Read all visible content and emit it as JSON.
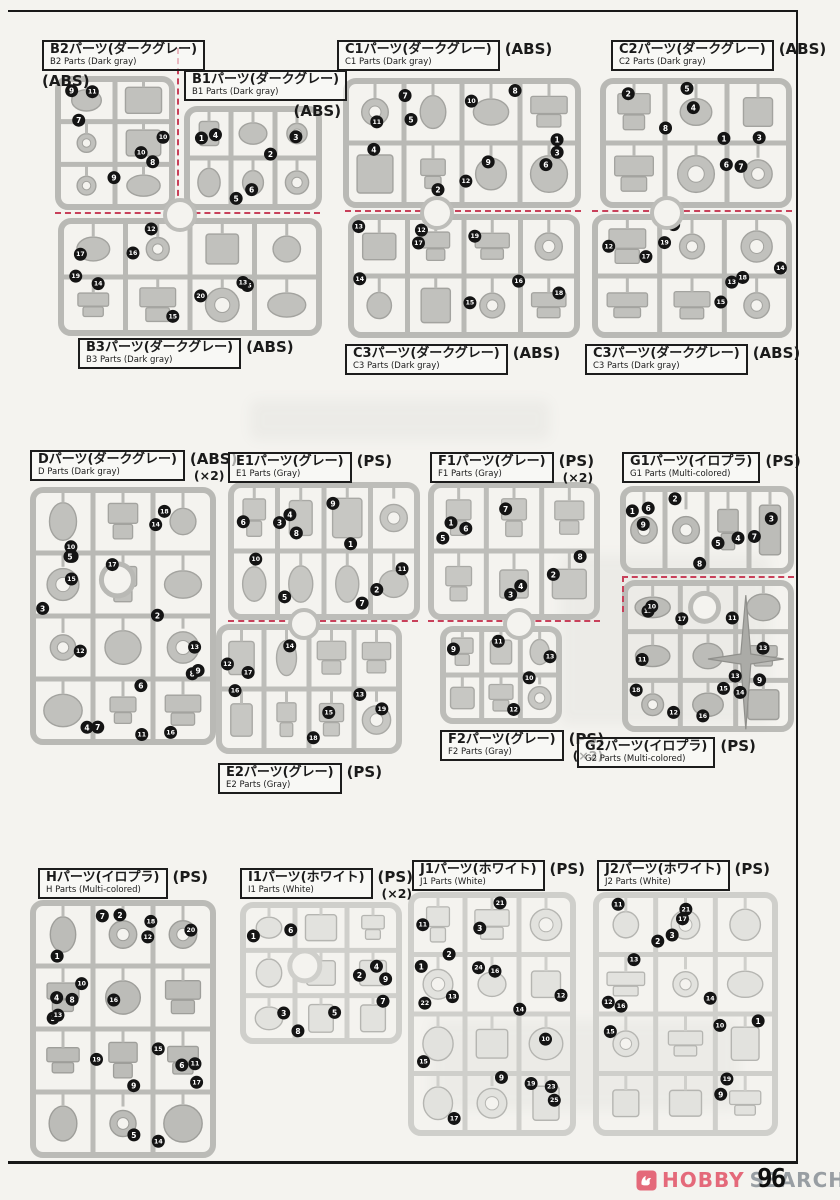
{
  "page": {
    "number": "96",
    "logo": {
      "hobby": "HOBBY",
      "search": "SEARCH"
    }
  },
  "colors": {
    "cut_line": "#c8405a",
    "logo_pink": "#e4697a",
    "logo_gray": "#989ea3",
    "sprue_gray": "#bdbdb9",
    "paper": "#f4f3ef"
  },
  "sections": {
    "B2": {
      "title_jp": "B2パーツ(ダークグレー)",
      "title_en": "B2 Parts (Dark gray)",
      "material": "(ABS)",
      "multiplier": ""
    },
    "B1": {
      "title_jp": "B1パーツ(ダークグレー)",
      "title_en": "B1 Parts (Dark gray)",
      "material": "(ABS)",
      "multiplier": ""
    },
    "B3": {
      "title_jp": "B3パーツ(ダークグレー)",
      "title_en": "B3 Parts (Dark gray)",
      "material": "(ABS)",
      "multiplier": ""
    },
    "C1": {
      "title_jp": "C1パーツ(ダークグレー)",
      "title_en": "C1 Parts (Dark gray)",
      "material": "(ABS)",
      "multiplier": ""
    },
    "C2": {
      "title_jp": "C2パーツ(ダークグレー)",
      "title_en": "C2 Parts (Dark gray)",
      "material": "(ABS)",
      "multiplier": ""
    },
    "C3a": {
      "title_jp": "C3パーツ(ダークグレー)",
      "title_en": "C3 Parts (Dark gray)",
      "material": "(ABS)",
      "multiplier": ""
    },
    "C3b": {
      "title_jp": "C3パーツ(ダークグレー)",
      "title_en": "C3 Parts (Dark gray)",
      "material": "(ABS)",
      "multiplier": ""
    },
    "D": {
      "title_jp": "Dパーツ(ダークグレー)",
      "title_en": "D Parts (Dark gray)",
      "material": "(ABS)",
      "multiplier": "(×2)"
    },
    "E1": {
      "title_jp": "E1パーツ(グレー)",
      "title_en": "E1 Parts (Gray)",
      "material": "(PS)",
      "multiplier": ""
    },
    "E2": {
      "title_jp": "E2パーツ(グレー)",
      "title_en": "E2 Parts (Gray)",
      "material": "(PS)",
      "multiplier": ""
    },
    "F1": {
      "title_jp": "F1パーツ(グレー)",
      "title_en": "F1 Parts (Gray)",
      "material": "(PS)",
      "multiplier": "(×2)"
    },
    "F2": {
      "title_jp": "F2パーツ(グレー)",
      "title_en": "F2 Parts (Gray)",
      "material": "(PS)",
      "multiplier": "(×2)"
    },
    "G1": {
      "title_jp": "G1パーツ(イロプラ)",
      "title_en": "G1 Parts (Multi-colored)",
      "material": "(PS)",
      "multiplier": ""
    },
    "G2": {
      "title_jp": "G2パーツ(イロプラ)",
      "title_en": "G2 Parts (Multi-colored)",
      "material": "(PS)",
      "multiplier": ""
    },
    "H": {
      "title_jp": "Hパーツ(イロプラ)",
      "title_en": "H Parts (Multi-colored)",
      "material": "(PS)",
      "multiplier": ""
    },
    "I1": {
      "title_jp": "I1パーツ(ホワイト)",
      "title_en": "I1 Parts (White)",
      "material": "(PS)",
      "multiplier": "(×2)"
    },
    "J1": {
      "title_jp": "J1パーツ(ホワイト)",
      "title_en": "J1 Parts (White)",
      "material": "(PS)",
      "multiplier": ""
    },
    "J2": {
      "title_jp": "J2パーツ(ホワイト)",
      "title_en": "J2 Parts (White)",
      "material": "(PS)",
      "multiplier": ""
    }
  },
  "runners": {
    "B2": {
      "numbers": [
        "9",
        "10",
        "11",
        "10",
        "9",
        "7",
        "8"
      ]
    },
    "B1": {
      "numbers": [
        "1",
        "2",
        "5",
        "3",
        "6",
        "4"
      ]
    },
    "B3": {
      "numbers": [
        "17",
        "15",
        "12",
        "19",
        "20",
        "16",
        "13",
        "15",
        "14"
      ]
    },
    "C1": {
      "numbers": [
        "7",
        "9",
        "2",
        "1",
        "12",
        "11",
        "3",
        "10",
        "4",
        "8",
        "5",
        "6"
      ]
    },
    "C3m": {
      "numbers": [
        "13",
        "16",
        "12",
        "14",
        "15",
        "17",
        "18",
        "19"
      ]
    },
    "C2": {
      "numbers": [
        "2",
        "1",
        "5",
        "3",
        "6",
        "8",
        "7",
        "4"
      ]
    },
    "C3r": {
      "numbers": [
        "12",
        "13",
        "16",
        "14",
        "15",
        "17",
        "18",
        "19"
      ]
    },
    "D": {
      "numbers": [
        "1",
        "2",
        "4",
        "3",
        "6",
        "5",
        "8",
        "7",
        "15",
        "16",
        "10",
        "9",
        "11",
        "12",
        "18",
        "17",
        "13",
        "14"
      ]
    },
    "E1": {
      "numbers": [
        "3",
        "1",
        "5",
        "6",
        "7",
        "8",
        "11",
        "9",
        "10",
        "2",
        "4"
      ]
    },
    "E2": {
      "numbers": [
        "12",
        "13",
        "14",
        "16",
        "15",
        "17",
        "19",
        "18"
      ]
    },
    "F1": {
      "numbers": [
        "1",
        "2",
        "3",
        "5",
        "4",
        "6",
        "8",
        "7"
      ]
    },
    "F2": {
      "numbers": [
        "9",
        "10",
        "11",
        "13",
        "12"
      ]
    },
    "G1": {
      "numbers": [
        "1",
        "4",
        "2",
        "3",
        "5",
        "6",
        "7",
        "8",
        "9"
      ]
    },
    "G2": {
      "numbers": [
        "12",
        "13",
        "12",
        "13",
        "14",
        "10",
        "9",
        "16",
        "11",
        "15",
        "17",
        "18",
        "11"
      ]
    },
    "H": {
      "numbers": [
        "1",
        "15",
        "2",
        "3",
        "5",
        "4",
        "6",
        "7",
        "8",
        "9",
        "10",
        "11",
        "12",
        "13",
        "14",
        "16",
        "17",
        "18",
        "19",
        "20"
      ]
    },
    "I1": {
      "numbers": [
        "1",
        "2",
        "3",
        "4",
        "5",
        "6",
        "7",
        "8",
        "9"
      ]
    },
    "J1": {
      "numbers": [
        "11",
        "14",
        "17",
        "1",
        "9",
        "2",
        "10",
        "3",
        "12",
        "19",
        "13",
        "15",
        "21",
        "22",
        "23",
        "24",
        "25",
        "16"
      ]
    },
    "J2": {
      "numbers": [
        "11",
        "14",
        "17",
        "1",
        "9",
        "2",
        "10",
        "3",
        "12",
        "19",
        "13",
        "15",
        "21",
        "16"
      ]
    }
  }
}
